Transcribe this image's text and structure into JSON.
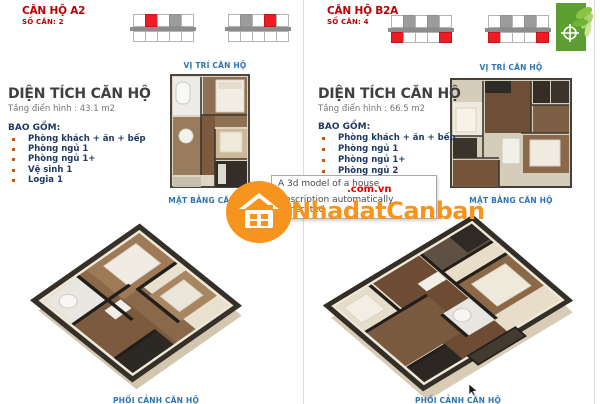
{
  "colors": {
    "unit_red": "#C00000",
    "label_blue": "#2E74B5",
    "list_navy": "#1F3864",
    "bullet": "#C55A11",
    "grid_red": "#EE1C25",
    "grid_gray": "#9C9C9C",
    "watermark_orange": "#F7941D",
    "watermark_red": "#E60000",
    "logo_green": "#5C9E31"
  },
  "watermark": {
    "brand": "NhadatCanban",
    "suffix": ".com.vn",
    "icon": "house-icon"
  },
  "tooltip": {
    "line1": "A 3d model of a house",
    "line2": "Description automatically generated"
  },
  "panels": [
    {
      "unit_name": "CĂN HỘ A2",
      "unit_count": "SỐ CĂN: 2",
      "position_grids": [
        {
          "top": [
            "w",
            "r",
            "w",
            "g",
            "w"
          ],
          "bottom": [
            "w",
            "w",
            "w",
            "w",
            "w"
          ]
        },
        {
          "top": [
            "w",
            "g",
            "w",
            "r",
            "w"
          ],
          "bottom": [
            "w",
            "w",
            "w",
            "w",
            "w"
          ]
        }
      ],
      "position_label": "VỊ TRÍ CĂN HỘ",
      "area_title": "DIỆN TÍCH CĂN HỘ",
      "area_subtitle": "Tầng điển hình : 43.1 m2",
      "includes_label": "BAO GỒM:",
      "includes": [
        "Phòng khách + ăn + bếp",
        "Phòng ngủ 1",
        "Phòng ngủ 1+",
        "Vệ sinh 1",
        "Logia 1"
      ],
      "plan_label": "MẶT BẰNG CĂN HỘ",
      "perspective_label": "PHỐI CẢNH CĂN HỘ"
    },
    {
      "unit_name": "CĂN HỘ B2A",
      "unit_count": "SỐ CĂN: 4",
      "position_grids": [
        {
          "top": [
            "w",
            "g",
            "w",
            "g",
            "w"
          ],
          "bottom": [
            "r",
            "w",
            "w",
            "w",
            "r"
          ]
        },
        {
          "top": [
            "w",
            "g",
            "w",
            "g",
            "w"
          ],
          "bottom": [
            "r",
            "w",
            "w",
            "w",
            "r"
          ]
        }
      ],
      "position_label": "VỊ TRÍ CĂN HỘ",
      "area_title": "DIỆN TÍCH CĂN HỘ",
      "area_subtitle": "Tầng điển hình : 66.5 m2",
      "includes_label": "BAO GỒM:",
      "includes": [
        "Phòng khách + ăn + bếp",
        "Phòng ngủ 1",
        "Phòng ngủ 1+",
        "Phòng ngủ 2",
        "",
        "",
        "",
        "Logia 2"
      ],
      "plan_label": "MẶT BẰNG CĂN HỘ",
      "perspective_label": "PHỐI CẢNH CĂN HỘ"
    }
  ]
}
